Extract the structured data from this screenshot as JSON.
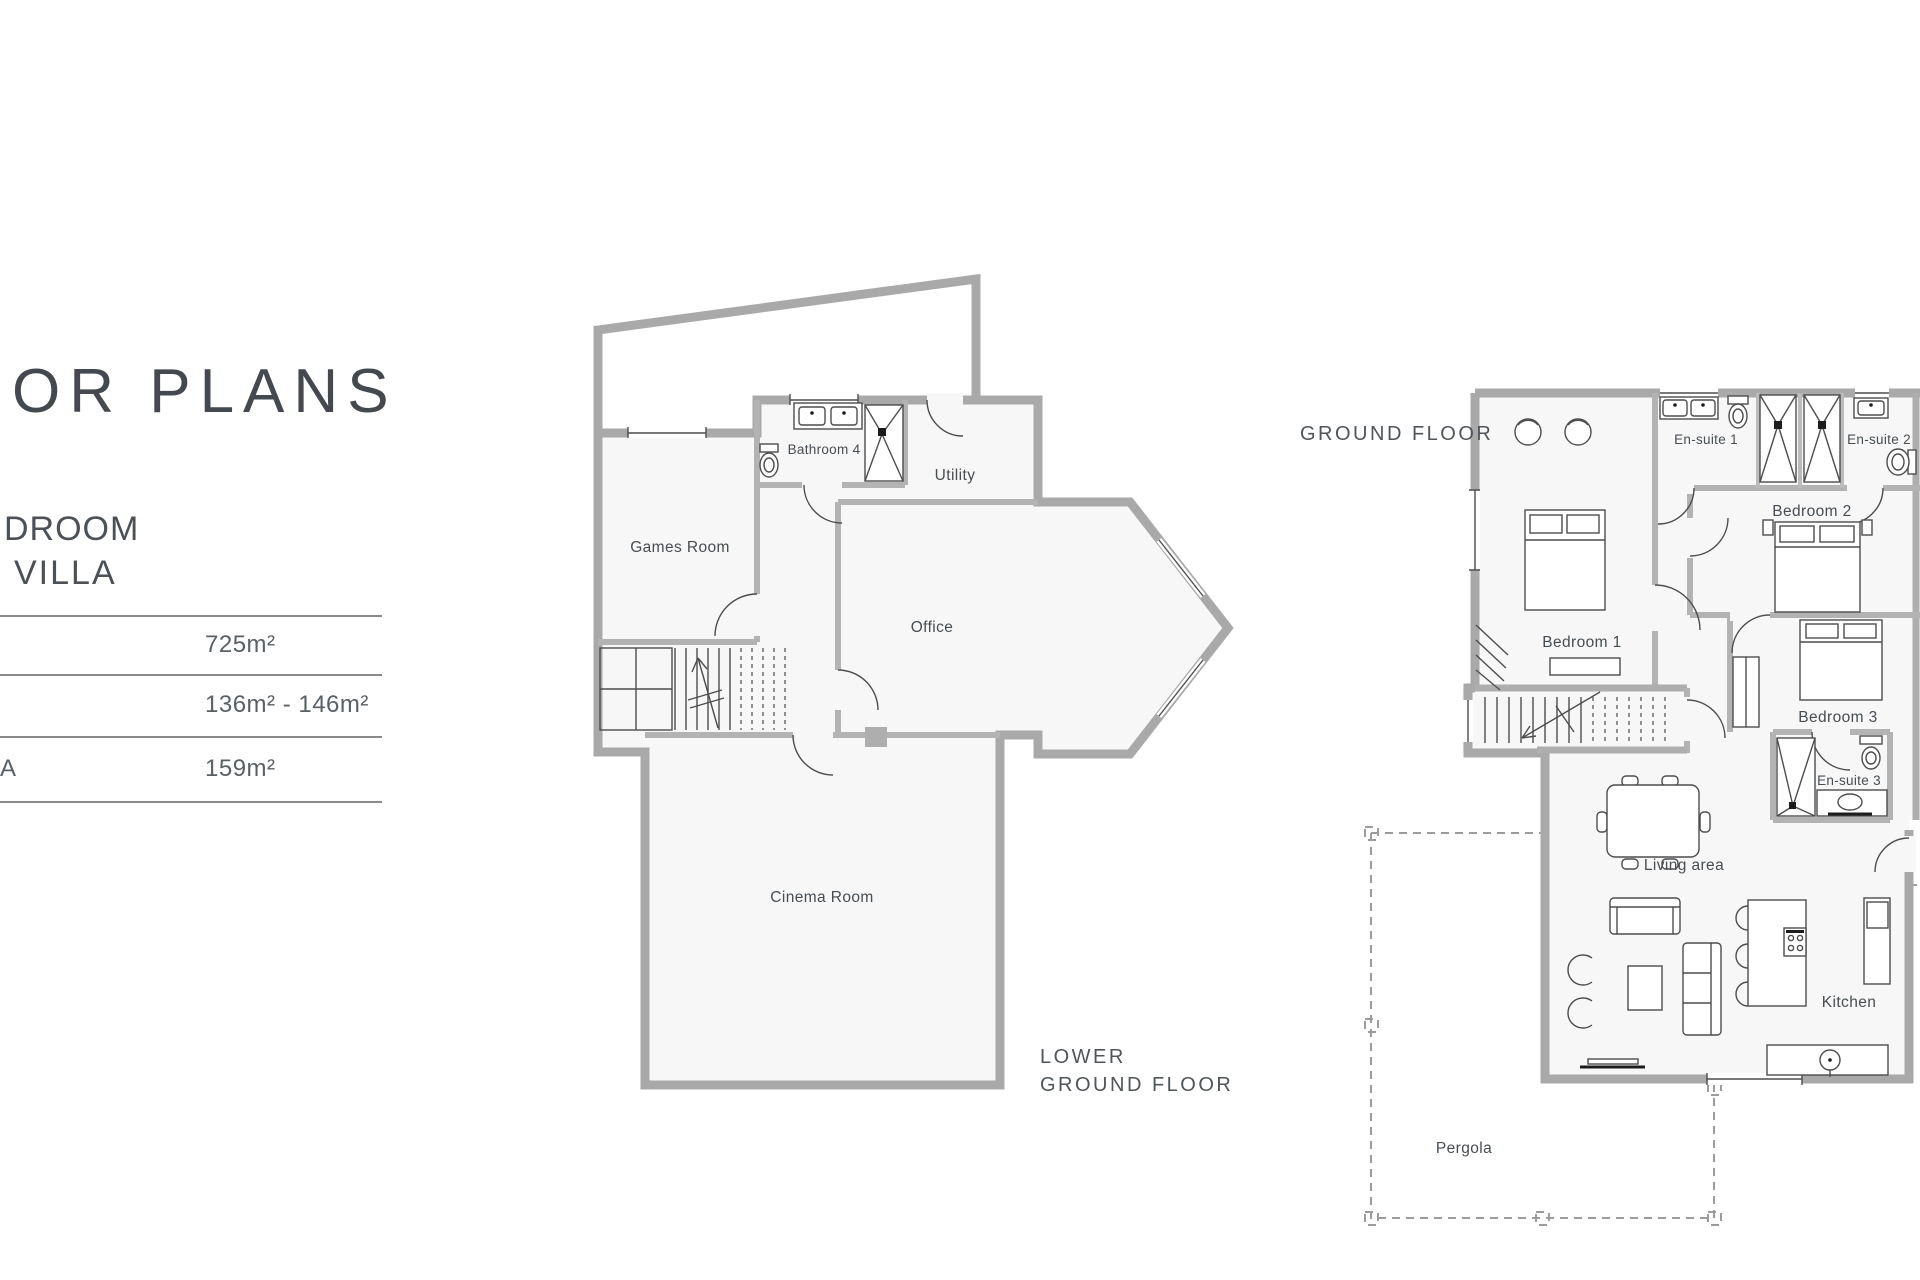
{
  "header": {
    "title": "OR PLANS",
    "subtitle_line1": "DROOM",
    "subtitle_line2": "VILLA"
  },
  "area_table": {
    "rows": [
      {
        "label": "",
        "value": "725m²"
      },
      {
        "label": "",
        "value": "136m² - 146m²"
      },
      {
        "label": "A",
        "value": "159m²"
      }
    ]
  },
  "plans": {
    "lower": {
      "caption_line1": "LOWER",
      "caption_line2": "GROUND FLOOR",
      "rooms": {
        "games": "Games Room",
        "bathroom4": "Bathroom 4",
        "utility": "Utility",
        "office": "Office",
        "cinema": "Cinema Room"
      }
    },
    "ground": {
      "caption": "GROUND FLOOR",
      "rooms": {
        "bedroom1": "Bedroom 1",
        "ensuite1": "En-suite 1",
        "ensuite2": "En-suite 2",
        "bedroom2": "Bedroom 2",
        "bedroom3": "Bedroom 3",
        "ensuite3": "En-suite 3",
        "living": "Living area",
        "kitchen": "Kitchen",
        "pergola": "Pergola"
      }
    }
  },
  "colors": {
    "wall": "#a9a9a9",
    "room_fill": "#f7f7f7",
    "line": "#4d4d4d",
    "text": "#4b5156"
  }
}
